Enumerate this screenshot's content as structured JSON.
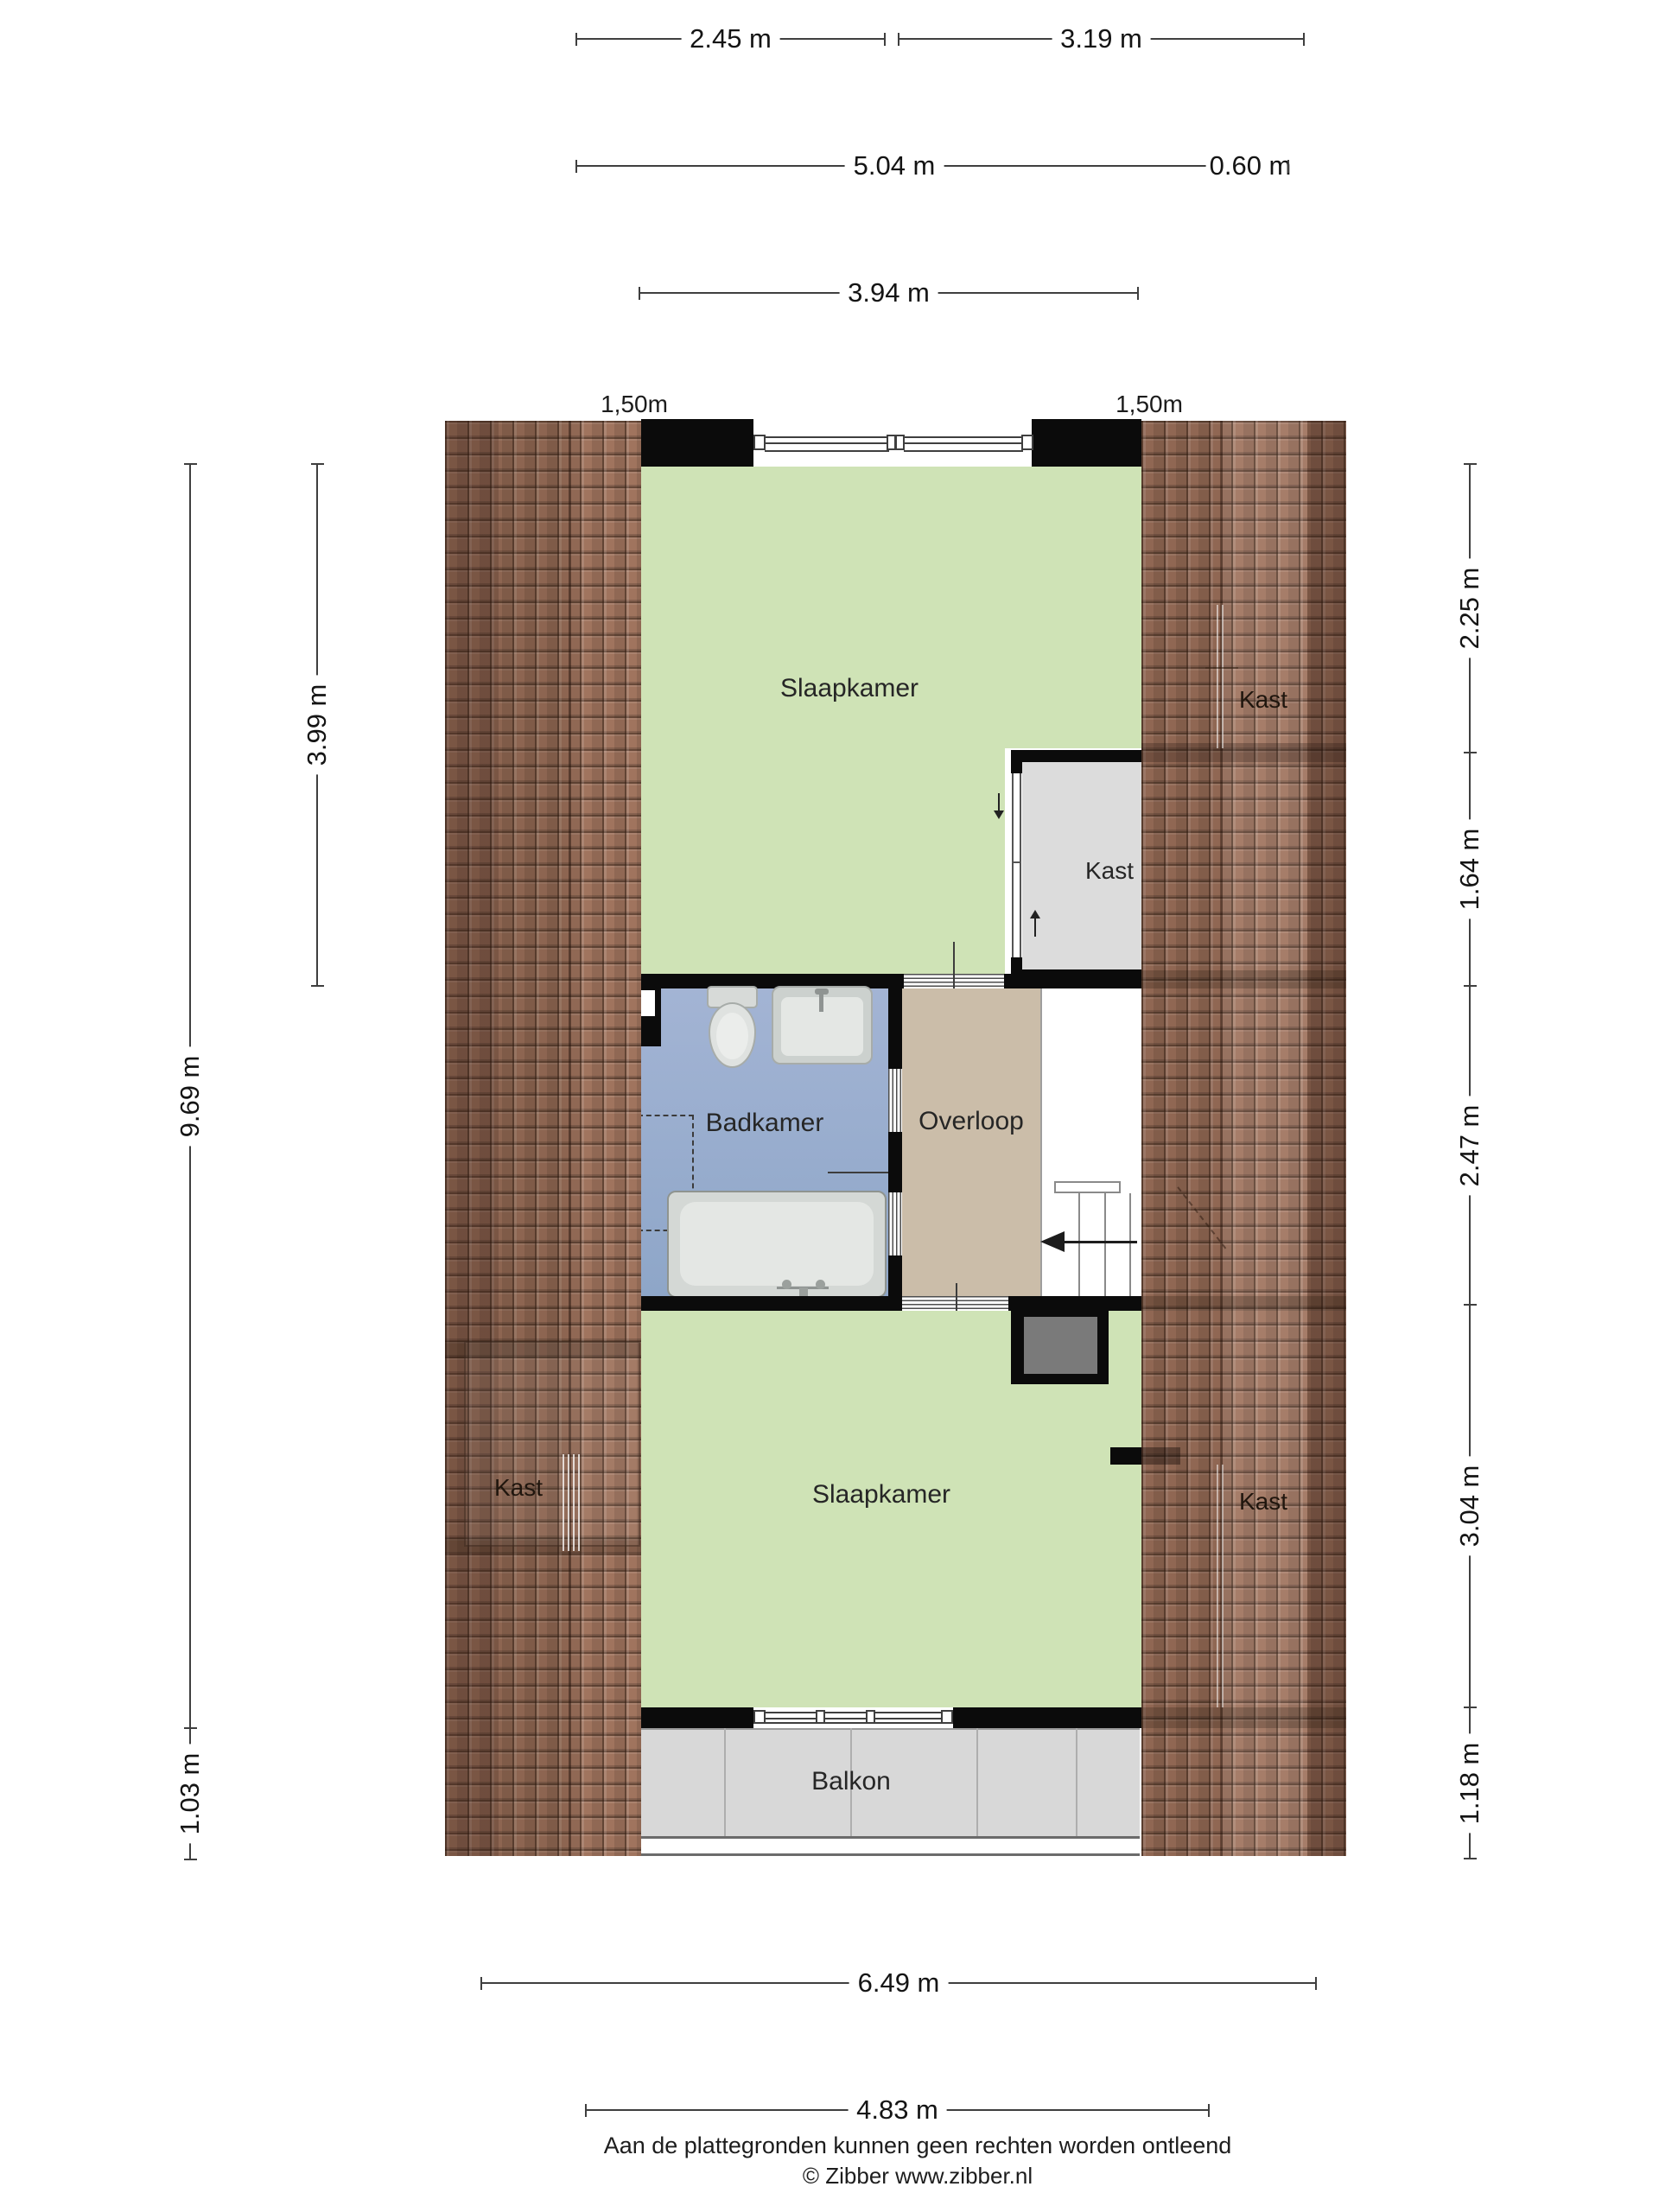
{
  "dimensions": {
    "top_left": "2.45 m",
    "top_right": "3.19 m",
    "mid_width": "5.04 m",
    "mid_offset": "0.60 m",
    "inner_width": "3.94 m",
    "knee_left": "1,50m",
    "knee_right": "1,50m",
    "left_bedroom": "3.99 m",
    "left_total": "9.69 m",
    "left_balcony": "1.03 m",
    "right_1": "2.25 m",
    "right_2": "1.64 m",
    "right_3": "2.47 m",
    "right_4": "3.04 m",
    "right_5": "1.18 m",
    "bottom_outer": "6.49 m",
    "bottom_inner": "4.83 m"
  },
  "rooms": {
    "bedroom_top": "Slaapkamer",
    "bedroom_bottom": "Slaapkamer",
    "bathroom": "Badkamer",
    "landing": "Overloop",
    "balcony": "Balkon",
    "closet_roof_top_right": "Kast",
    "closet_top_right": "Kast",
    "closet_roof_left": "Kast",
    "closet_roof_bottom_right": "Kast"
  },
  "footer": {
    "disclaimer": "Aan de plattegronden kunnen geen rechten worden ontleend",
    "copyright": "© Zibber www.zibber.nl"
  },
  "colors": {
    "roof_tile": "#a0745e",
    "room_green": "#cfe3b6",
    "bathroom_blue": "#9cb0d2",
    "landing_tan": "#cbbda9",
    "closet_gray": "#dcdcdc",
    "balcony_gray": "#d8d8d8",
    "chimney_gray": "#7a7a7a",
    "wall_black": "#0b0b0b"
  }
}
